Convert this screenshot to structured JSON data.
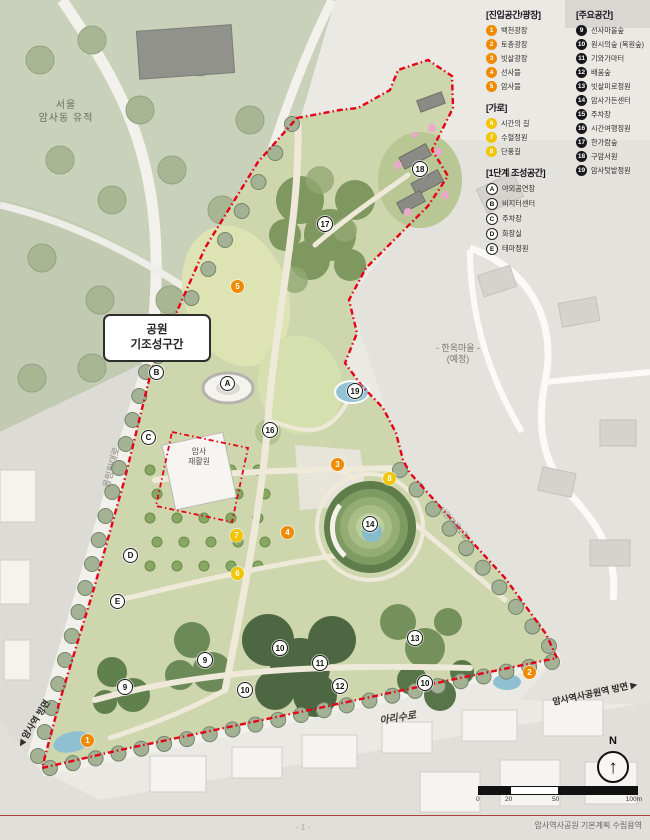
{
  "legend": {
    "entry": {
      "title": "[진입공간/광장]",
      "items": [
        {
          "n": "1",
          "label": "백천광장"
        },
        {
          "n": "2",
          "label": "토층광장"
        },
        {
          "n": "3",
          "label": "빗살광장"
        },
        {
          "n": "4",
          "label": "선사뜰"
        },
        {
          "n": "5",
          "label": "암사뜰"
        }
      ]
    },
    "street": {
      "title": "[가로]",
      "items": [
        {
          "n": "6",
          "label": "시간의 길"
        },
        {
          "n": "7",
          "label": "수혈정원"
        },
        {
          "n": "8",
          "label": "단풍길"
        }
      ]
    },
    "phase1": {
      "title": "[1단계 조성공간]",
      "items": [
        {
          "n": "A",
          "label": "야외공연장"
        },
        {
          "n": "B",
          "label": "비지터센터"
        },
        {
          "n": "C",
          "label": "주차장"
        },
        {
          "n": "D",
          "label": "화장실"
        },
        {
          "n": "E",
          "label": "테마정원"
        }
      ]
    },
    "main": {
      "title": "[주요공간]",
      "items": [
        {
          "n": "9",
          "label": "선사마을숲"
        },
        {
          "n": "10",
          "label": "원시의숲 (복원숲)"
        },
        {
          "n": "11",
          "label": "기와가마터"
        },
        {
          "n": "12",
          "label": "배움숲"
        },
        {
          "n": "13",
          "label": "빗살미로정원"
        },
        {
          "n": "14",
          "label": "암사가든센터"
        },
        {
          "n": "15",
          "label": "주차장"
        },
        {
          "n": "16",
          "label": "시간여행정원"
        },
        {
          "n": "17",
          "label": "한가람숲"
        },
        {
          "n": "18",
          "label": "구암서원"
        },
        {
          "n": "19",
          "label": "암사텃밭정원"
        }
      ]
    }
  },
  "labels": {
    "historic_site_line1": "서울",
    "historic_site_line2": "암사동 유적",
    "existing_section_line1": "공원",
    "existing_section_line2": "기조성구간",
    "hanok_line1": "- 한옥마을 -",
    "hanok_line2": "(예정)",
    "rehab_line1": "암사",
    "rehab_line2": "재활원",
    "road_arisu": "아리수로",
    "road_olympic": "올림픽대로",
    "road_seowon": "서원마을1길",
    "dir_amsa_station": "◀ 암사역 방면",
    "dir_park_station": "암사역사공원역 방면 ▶",
    "north": "N",
    "north_arrow": "↑"
  },
  "scale_bar": {
    "ticks": [
      "0",
      "20",
      "50",
      "100m"
    ]
  },
  "footer": {
    "caption": "암사역사공원 기본계획 수립용역",
    "page": "- 1 -"
  },
  "markers": [
    {
      "t": "orange",
      "label": "1",
      "x": 88,
      "y": 741
    },
    {
      "t": "orange",
      "label": "2",
      "x": 530,
      "y": 673
    },
    {
      "t": "orange",
      "label": "3",
      "x": 338,
      "y": 465
    },
    {
      "t": "orange",
      "label": "4",
      "x": 288,
      "y": 533
    },
    {
      "t": "orange",
      "label": "5",
      "x": 238,
      "y": 287
    },
    {
      "t": "yellow",
      "label": "6",
      "x": 238,
      "y": 574
    },
    {
      "t": "yellow",
      "label": "7",
      "x": 237,
      "y": 536
    },
    {
      "t": "yellow",
      "label": "8",
      "x": 390,
      "y": 479
    },
    {
      "t": "white",
      "label": "9",
      "x": 205,
      "y": 660
    },
    {
      "t": "white",
      "label": "9",
      "x": 125,
      "y": 687
    },
    {
      "t": "white",
      "label": "10",
      "x": 280,
      "y": 648
    },
    {
      "t": "white",
      "label": "10",
      "x": 245,
      "y": 690
    },
    {
      "t": "white",
      "label": "10",
      "x": 425,
      "y": 683
    },
    {
      "t": "white",
      "label": "11",
      "x": 320,
      "y": 663
    },
    {
      "t": "white",
      "label": "12",
      "x": 340,
      "y": 686
    },
    {
      "t": "white",
      "label": "13",
      "x": 415,
      "y": 638
    },
    {
      "t": "white",
      "label": "14",
      "x": 370,
      "y": 524
    },
    {
      "t": "white",
      "label": "16",
      "x": 270,
      "y": 430
    },
    {
      "t": "white",
      "label": "17",
      "x": 325,
      "y": 224
    },
    {
      "t": "white",
      "label": "18",
      "x": 420,
      "y": 169
    },
    {
      "t": "white",
      "label": "19",
      "x": 355,
      "y": 391
    },
    {
      "t": "letter",
      "label": "A",
      "x": 227,
      "y": 383
    },
    {
      "t": "letter",
      "label": "B",
      "x": 156,
      "y": 372
    },
    {
      "t": "letter",
      "label": "C",
      "x": 148,
      "y": 437
    },
    {
      "t": "letter",
      "label": "D",
      "x": 130,
      "y": 555
    },
    {
      "t": "letter",
      "label": "E",
      "x": 117,
      "y": 601
    }
  ],
  "colors": {
    "boundary_red": "#e60018",
    "marker_orange": "#f08b00",
    "marker_yellow": "#f3c400",
    "marker_dark": "#17171a"
  }
}
